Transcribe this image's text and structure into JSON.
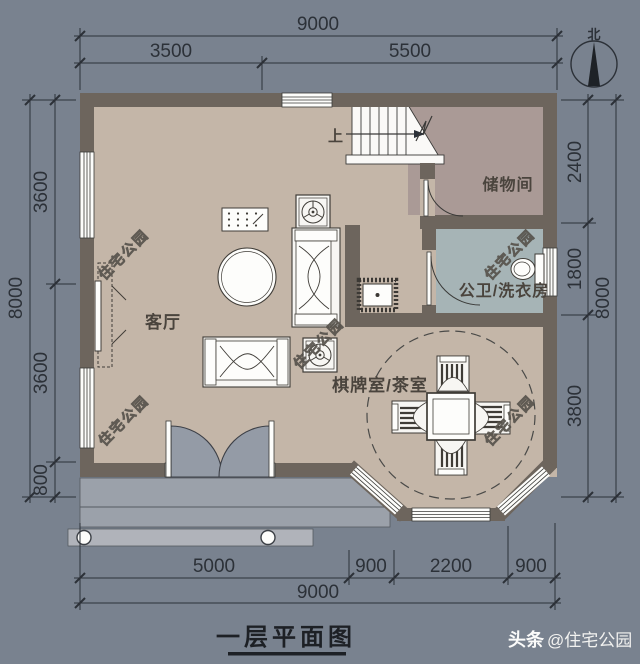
{
  "title": {
    "text": "一层平面图"
  },
  "credit": {
    "prefix": "头条",
    "handle": "@住宅公园"
  },
  "north": {
    "label": "北"
  },
  "watermark": {
    "text": "住宅公园"
  },
  "plan": {
    "stairs": {
      "label": "上"
    },
    "rooms": [
      {
        "id": "living",
        "label": "客厅"
      },
      {
        "id": "storage",
        "label": "储物间"
      },
      {
        "id": "bath",
        "label": "公卫/洗衣房"
      },
      {
        "id": "tea",
        "label": "棋牌室/茶室"
      }
    ]
  },
  "dimensions": {
    "top": {
      "total": "9000",
      "segments": [
        "3500",
        "5500"
      ]
    },
    "bottom": {
      "total": "9000",
      "segments": [
        "5000",
        "900",
        "2200",
        "900"
      ]
    },
    "left": {
      "total": "8000",
      "segments": [
        "3600",
        "3600",
        "800"
      ]
    },
    "right": {
      "total": "8000",
      "segments": [
        "2400",
        "1800",
        "3800"
      ]
    }
  },
  "palette": {
    "background": "#79828f",
    "wall": "#6d655d",
    "floor_living": "#c4b6a8",
    "floor_storage": "#aa9a96",
    "floor_bath": "#a6b4b6",
    "porch": "#9ba1aa",
    "porch_strip": "#b0b3ba",
    "line": "#2c3138",
    "white": "#f7f6f3"
  }
}
